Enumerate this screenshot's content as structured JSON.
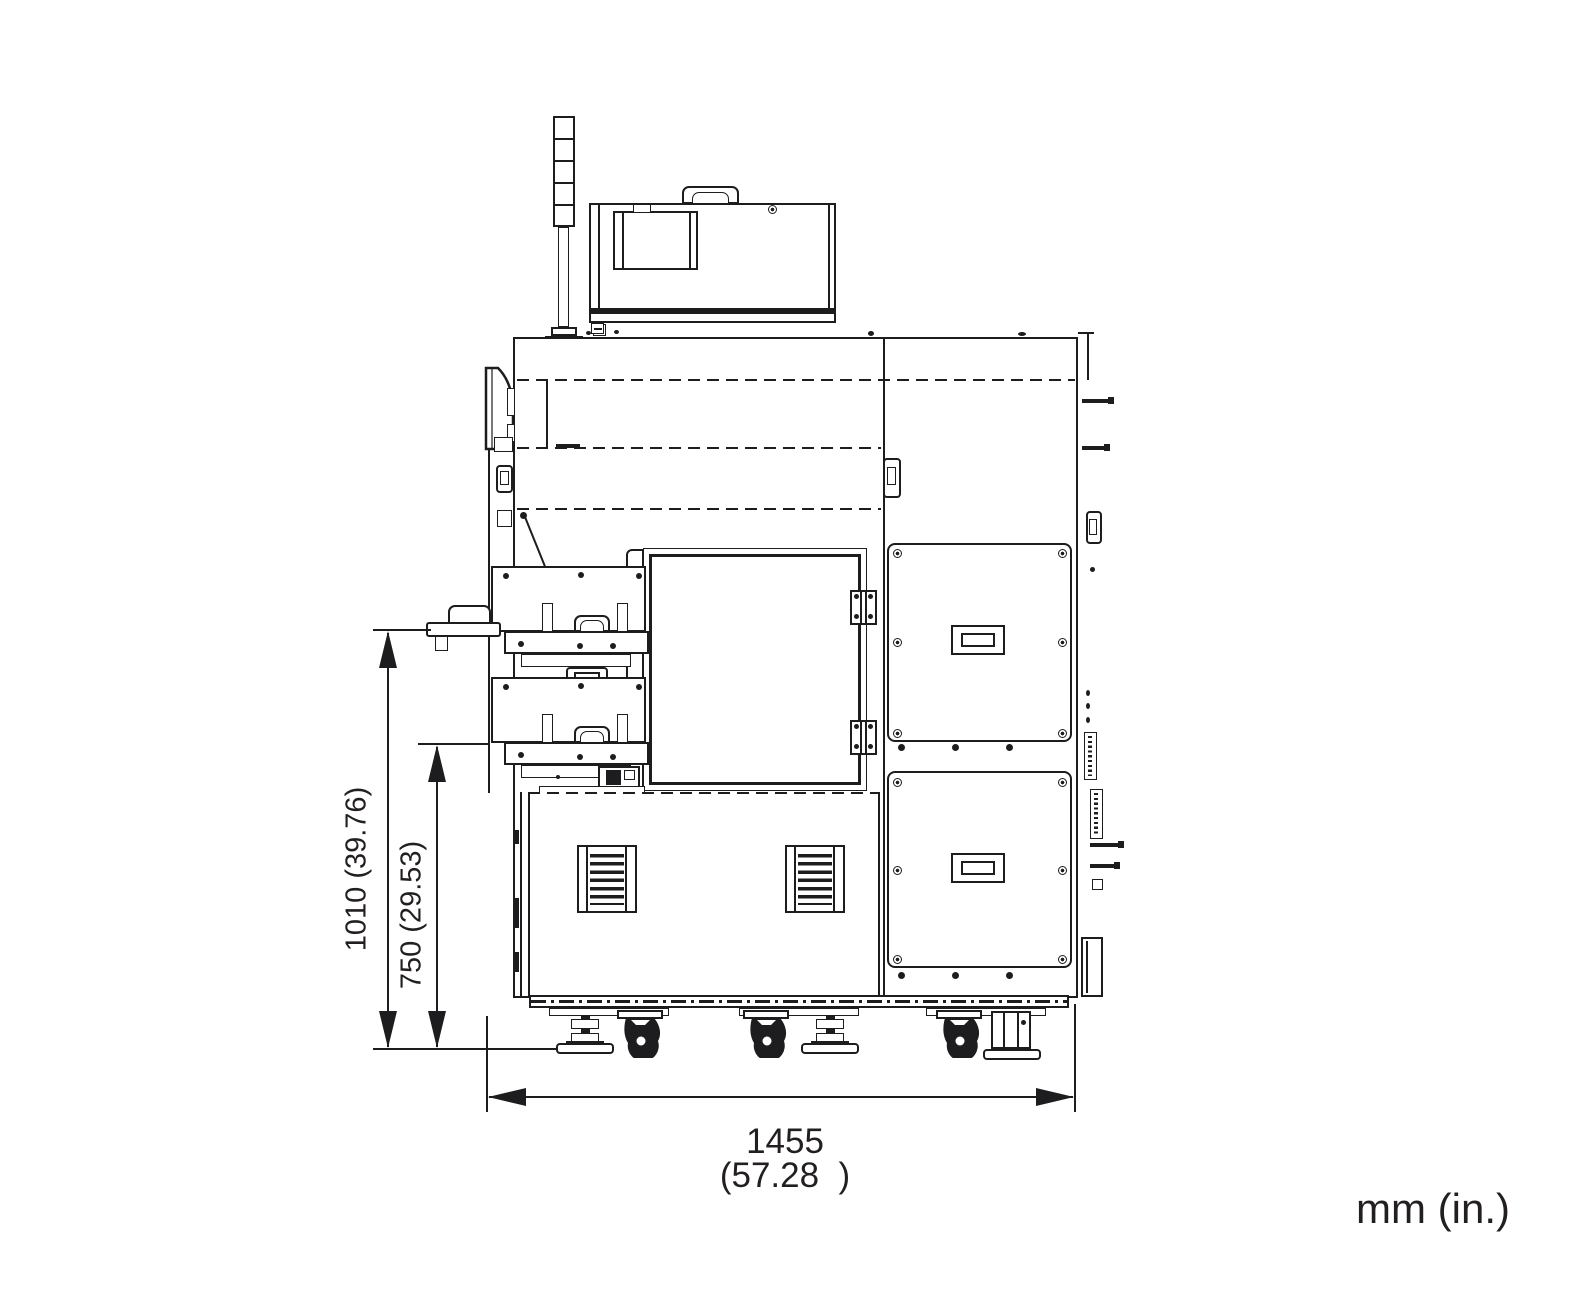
{
  "drawing": {
    "colors": {
      "line": "#1d1d1f",
      "text": "#231f20",
      "background": "#ffffff"
    },
    "labels": {
      "height_overall": "1010 (39.76)",
      "height_mid": "750 (29.53)",
      "width_mm": "1455",
      "width_in": "(57.28  )",
      "units": "mm (in.)"
    }
  }
}
